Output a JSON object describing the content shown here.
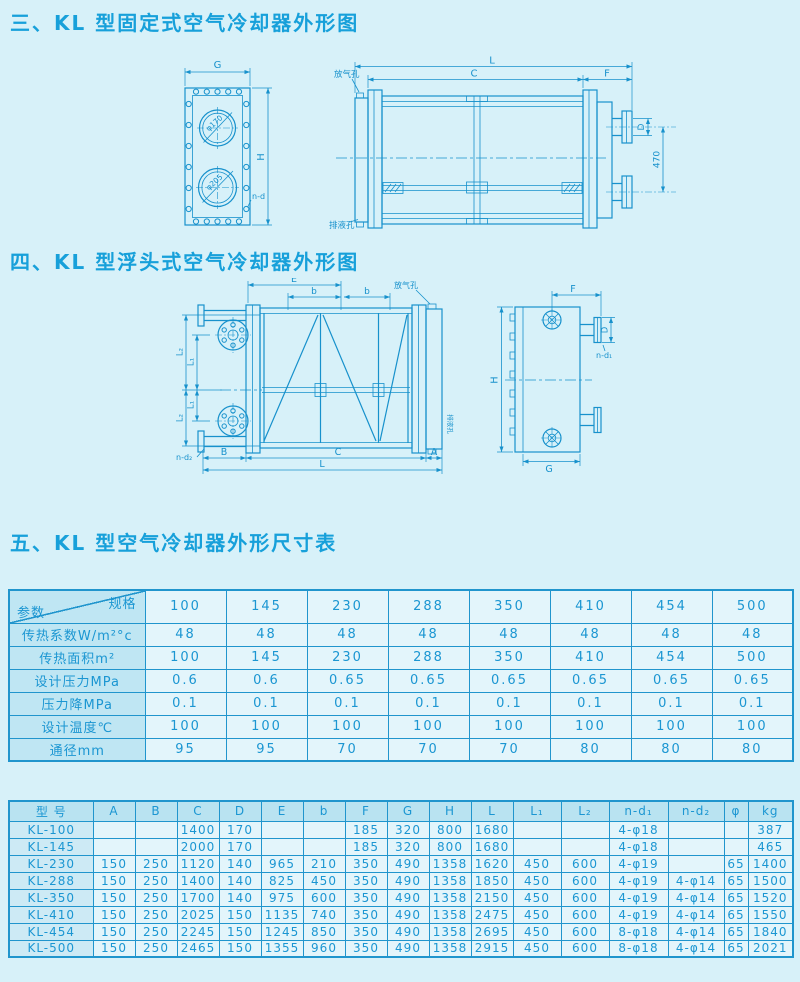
{
  "page": {
    "background": "#d7f1f9",
    "accent": "#1791cc"
  },
  "sections": {
    "fixed": {
      "title": "三、KL 型固定式空气冷却器外形图"
    },
    "floating": {
      "title": "四、KL 型浮头式空气冷却器外形图"
    },
    "dimensions": {
      "title": "五、KL 型空气冷却器外形尺寸表"
    }
  },
  "drawing_fixed": {
    "front_view": {
      "dim_G": "G",
      "dim_H": "H",
      "holes": "n-d",
      "top_circle": "φ170",
      "bottom_circle": "φ205"
    },
    "side_view": {
      "dim_L": "L",
      "dim_C": "C",
      "dim_F": "F",
      "dim_D": "D",
      "dim_470": "470",
      "vent_hole": "放气孔",
      "drain_hole": "排液孔"
    }
  },
  "drawing_floating": {
    "front_view": {
      "dim_E": "E",
      "dim_b1": "b",
      "dim_b2": "b",
      "dim_L1a": "L₁",
      "dim_L1b": "L₁",
      "dim_L2a": "L₂",
      "dim_L2b": "L₂",
      "dim_B": "B",
      "dim_C": "C",
      "dim_A": "A",
      "dim_L": "L",
      "holes": "n-d₂",
      "vent_hole": "放气孔",
      "drain_hole": "排液孔"
    },
    "side_view": {
      "dim_F": "F",
      "dim_D": "D",
      "dim_H": "H",
      "dim_G": "G",
      "holes": "n-d₁"
    }
  },
  "param_table": {
    "corner_top": "规格",
    "corner_bottom": "参数",
    "columns": [
      "100",
      "145",
      "230",
      "288",
      "350",
      "410",
      "454",
      "500"
    ],
    "rows": [
      {
        "label": "传热系数W/m²°c",
        "values": [
          "48",
          "48",
          "48",
          "48",
          "48",
          "48",
          "48",
          "48"
        ]
      },
      {
        "label": "传热面积m²",
        "values": [
          "100",
          "145",
          "230",
          "288",
          "350",
          "410",
          "454",
          "500"
        ]
      },
      {
        "label": "设计压力MPa",
        "values": [
          "0.6",
          "0.6",
          "0.65",
          "0.65",
          "0.65",
          "0.65",
          "0.65",
          "0.65"
        ]
      },
      {
        "label": "压力降MPa",
        "values": [
          "0.1",
          "0.1",
          "0.1",
          "0.1",
          "0.1",
          "0.1",
          "0.1",
          "0.1"
        ]
      },
      {
        "label": "设计温度℃",
        "values": [
          "100",
          "100",
          "100",
          "100",
          "100",
          "100",
          "100",
          "100"
        ]
      },
      {
        "label": "通径mm",
        "values": [
          "95",
          "95",
          "70",
          "70",
          "70",
          "80",
          "80",
          "80"
        ]
      }
    ]
  },
  "dim_table": {
    "headers": [
      "型  号",
      "A",
      "B",
      "C",
      "D",
      "E",
      "b",
      "F",
      "G",
      "H",
      "L",
      "L₁",
      "L₂",
      "n-d₁",
      "n-d₂",
      "φ",
      "kg"
    ],
    "rows": [
      {
        "model": "KL-100",
        "values": [
          "",
          "",
          "1400",
          "170",
          "",
          "",
          "185",
          "320",
          "800",
          "1680",
          "",
          "",
          "4-φ18",
          "",
          "",
          "387"
        ]
      },
      {
        "model": "KL-145",
        "values": [
          "",
          "",
          "2000",
          "170",
          "",
          "",
          "185",
          "320",
          "800",
          "1680",
          "",
          "",
          "4-φ18",
          "",
          "",
          "465"
        ]
      },
      {
        "model": "KL-230",
        "values": [
          "150",
          "250",
          "1120",
          "140",
          "965",
          "210",
          "350",
          "490",
          "1358",
          "1620",
          "450",
          "600",
          "4-φ19",
          "",
          "65",
          "1400"
        ]
      },
      {
        "model": "KL-288",
        "values": [
          "150",
          "250",
          "1400",
          "140",
          "825",
          "450",
          "350",
          "490",
          "1358",
          "1850",
          "450",
          "600",
          "4-φ19",
          "4-φ14",
          "65",
          "1500"
        ]
      },
      {
        "model": "KL-350",
        "values": [
          "150",
          "250",
          "1700",
          "140",
          "975",
          "600",
          "350",
          "490",
          "1358",
          "2150",
          "450",
          "600",
          "4-φ19",
          "4-φ14",
          "65",
          "1520"
        ]
      },
      {
        "model": "KL-410",
        "values": [
          "150",
          "250",
          "2025",
          "150",
          "1135",
          "740",
          "350",
          "490",
          "1358",
          "2475",
          "450",
          "600",
          "4-φ19",
          "4-φ14",
          "65",
          "1550"
        ]
      },
      {
        "model": "KL-454",
        "values": [
          "150",
          "250",
          "2245",
          "150",
          "1245",
          "850",
          "350",
          "490",
          "1358",
          "2695",
          "450",
          "600",
          "8-φ18",
          "4-φ14",
          "65",
          "1840"
        ]
      },
      {
        "model": "KL-500",
        "values": [
          "150",
          "250",
          "2465",
          "150",
          "1355",
          "960",
          "350",
          "490",
          "1358",
          "2915",
          "450",
          "600",
          "8-φ18",
          "4-φ14",
          "65",
          "2021"
        ]
      }
    ]
  }
}
